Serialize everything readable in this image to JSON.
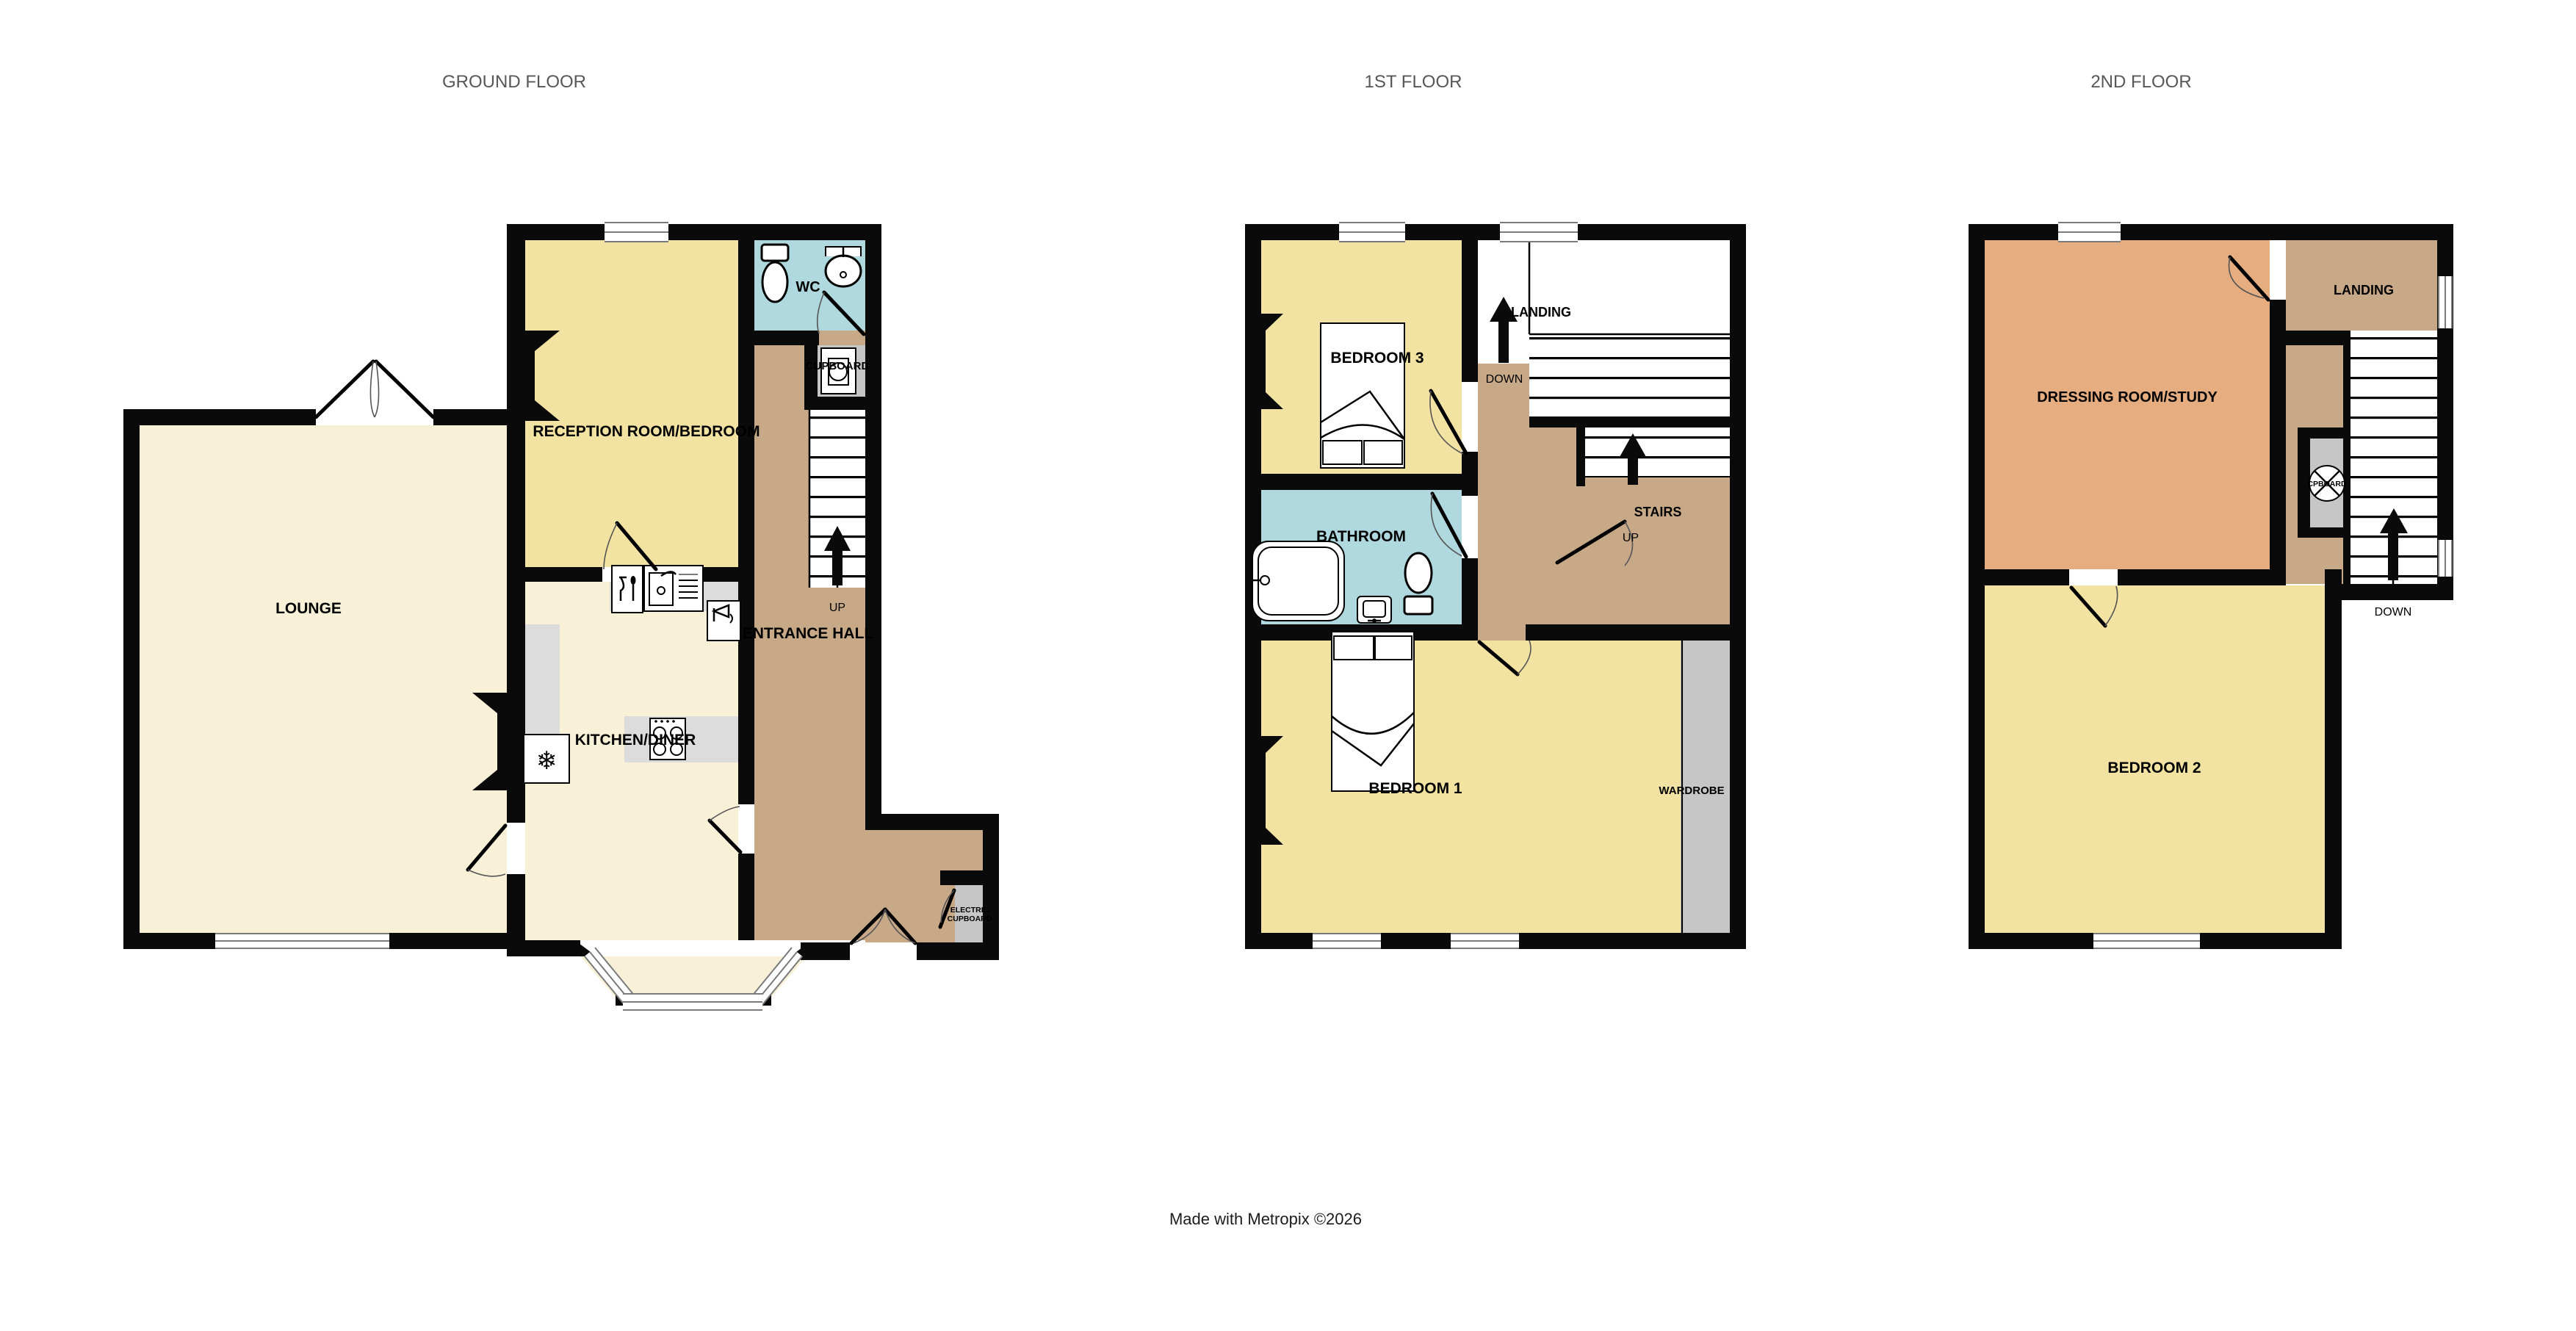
{
  "page": {
    "credit": "Made with Metropix ©2026"
  },
  "floors": {
    "ground": {
      "title": "GROUND FLOOR",
      "lounge": "LOUNGE",
      "reception": "RECEPTION ROOM/BEDROOM",
      "wc": "WC",
      "cupboard": "CUPBOARD",
      "kitchen": "KITCHEN/DINER",
      "hall": "ENTRANCE HALL",
      "up": "UP",
      "electric_line1": "ELECTRIC",
      "electric_line2": "CUPBOARD"
    },
    "first": {
      "title": "1ST FLOOR",
      "bedroom3": "BEDROOM 3",
      "landing": "LANDING",
      "down": "DOWN",
      "bathroom": "BATHROOM",
      "stairs": "STAIRS",
      "up": "UP",
      "bedroom1": "BEDROOM 1",
      "wardrobe": "WARDROBE"
    },
    "second": {
      "title": "2ND FLOOR",
      "dressing": "DRESSING ROOM/STUDY",
      "landing": "LANDING",
      "cpboard": "CPBOARD",
      "down": "DOWN",
      "bedroom2": "BEDROOM 2"
    }
  },
  "icons": {
    "freezer": "❄"
  },
  "colors": {
    "wall": "#0a0a0a",
    "room_yellow": "#F3E3A3",
    "room_cream": "#F8F1D8",
    "room_blue": "#AFD9DF",
    "hall_tan": "#C8A987",
    "room_salmon": "#E5AD80",
    "storage_gray": "#C6C6C6",
    "counter_gray": "#DCDCDC",
    "title_gray": "#575757"
  }
}
